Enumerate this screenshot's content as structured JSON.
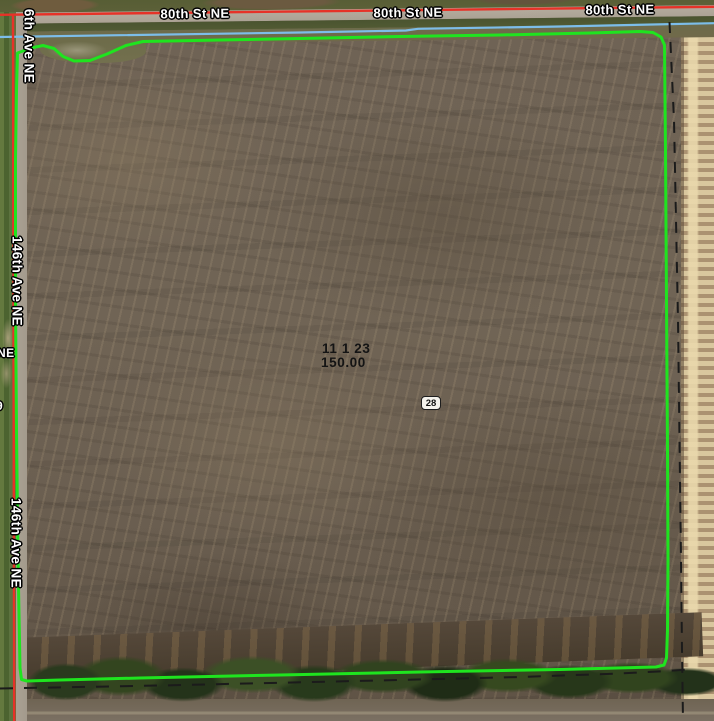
{
  "map": {
    "road_labels": [
      {
        "text": "80th St NE"
      },
      {
        "text": "80th St NE"
      },
      {
        "text": "80th St NE"
      }
    ],
    "avenue_labels": [
      {
        "text": "6th Ave NE"
      },
      {
        "text": "146th Ave NE"
      },
      {
        "text": "146th Ave NE"
      }
    ],
    "edge_labels": [
      {
        "text": "NE"
      },
      {
        "text": "9"
      }
    ],
    "parcel": {
      "id_line": "11 1 23",
      "acres_line": "150.00"
    },
    "section_marker": {
      "text": "28"
    },
    "colors": {
      "boundary_green": "#1fe41f",
      "road_centerline_red": "#e63228",
      "utility_line_blue": "#7cbde9",
      "section_dash_black": "#1b1b1b"
    }
  }
}
